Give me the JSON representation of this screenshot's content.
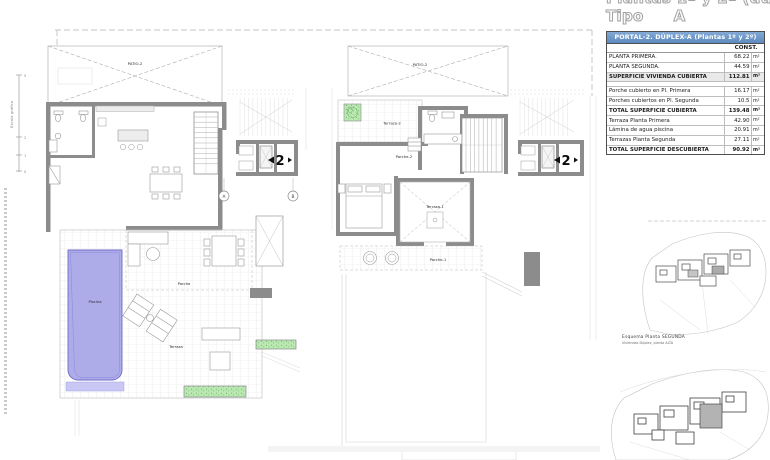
{
  "title": {
    "line1": "Plantas 1ª y 2ª (dúplex)",
    "line2_label": "Tipo",
    "line2_value": "A"
  },
  "table": {
    "header": "PORTAL-2. DÚPLEX-A (Plantas 1º y 2º)",
    "col_header": "CONST.",
    "unit": "m²",
    "rows": [
      {
        "label": "PLANTA PRIMERA.",
        "value": "68.22"
      },
      {
        "label": "PLANTA SEGUNDA.",
        "value": "44.59"
      },
      {
        "label": "SUPERFICIE VIVIENDA CUBIERTA",
        "value": "112.81"
      },
      {
        "label": "Porche cubierto en Pl. Primera",
        "value": "16.17"
      },
      {
        "label": "Porches cubiertos en Pl. Segunda",
        "value": "10.5"
      },
      {
        "label": "TOTAL SUPERFICIE CUBIERTA",
        "value": "139.48"
      },
      {
        "label": "Terraza Planta Primera",
        "value": "42.90"
      },
      {
        "label": "Lámina de agua piscina",
        "value": "20.91"
      },
      {
        "label": "Terrazas Planta Segunda",
        "value": "27.11"
      },
      {
        "label": "TOTAL SUPERFICIE DESCUBIERTA",
        "value": "90.92"
      }
    ]
  },
  "plan_left": {
    "patio_label": "PATIO-2",
    "porche_label": "Porche",
    "terraza_label": "Terraza",
    "piscina_label": "Piscina",
    "level": "2",
    "grid_a": "A",
    "grid_b": "B"
  },
  "plan_right": {
    "patio_label": "PATIO-2",
    "terraza2_label": "Terraza-2",
    "porche2_label": "Porche-2",
    "terraza1_label": "Terraza-1",
    "porche1_label": "Porche-1",
    "level": "2"
  },
  "scale_bar": {
    "label": "Escala gráfica",
    "ticks": [
      "5",
      "2",
      "1",
      "0"
    ]
  },
  "key_plans": {
    "caption_line1": "Esquema Planta SEGUNDA",
    "caption_line2": "Viviendas Dúplex, planta ALTA"
  },
  "colors": {
    "table_header_blue": "#5c8ac0",
    "pool_fill": "#aeabe9",
    "pool_edge": "#6e6bc7",
    "planter_green": "#b9e8b1",
    "wall_gray": "#8c8c8c"
  }
}
